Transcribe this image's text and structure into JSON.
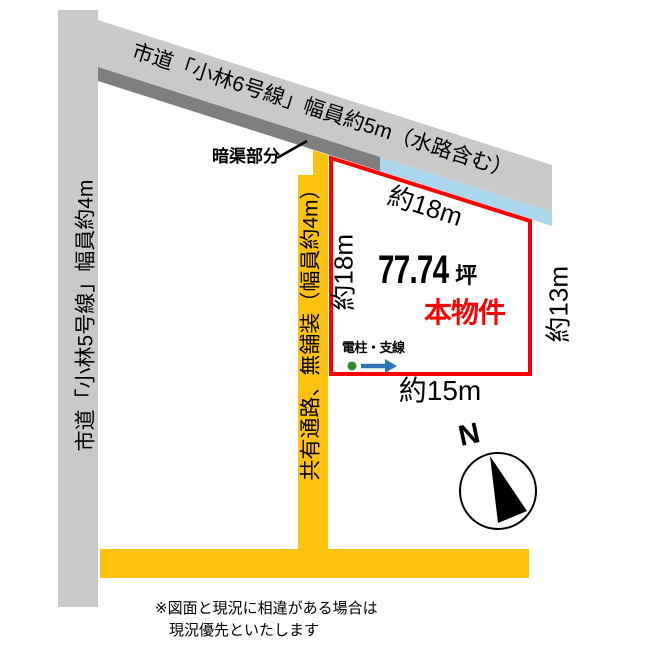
{
  "title": "土地区画図",
  "roads": {
    "road6_label": "市道「小林6号線」幅員約5m（水路含む）",
    "road5_label": "市道「小林5号線」幅員約4m",
    "passage_label": "共有通路、無舗装（幅員約4m）"
  },
  "plot": {
    "area_value": "77.74",
    "area_unit": "坪",
    "property_label": "本物件",
    "dimensions": {
      "top": "約18m",
      "left": "約18m",
      "right": "約13m",
      "bottom": "約15m"
    }
  },
  "annotations": {
    "culvert_label": "暗渠部分",
    "pole_label": "電柱・支線",
    "compass_n": "N",
    "note_line1": "※図面と現況に相違がある場合は",
    "note_line2": "現況優先といたします"
  },
  "colors": {
    "road_gray": "#c9c9c9",
    "culvert_gray": "#7f7f7f",
    "waterway_blue": "#aad7ee",
    "passage_yellow": "#ffc20e",
    "outline_red": "#ff0000",
    "pole_green": "#2e8b2e",
    "arrow_blue": "#2e75b6"
  }
}
